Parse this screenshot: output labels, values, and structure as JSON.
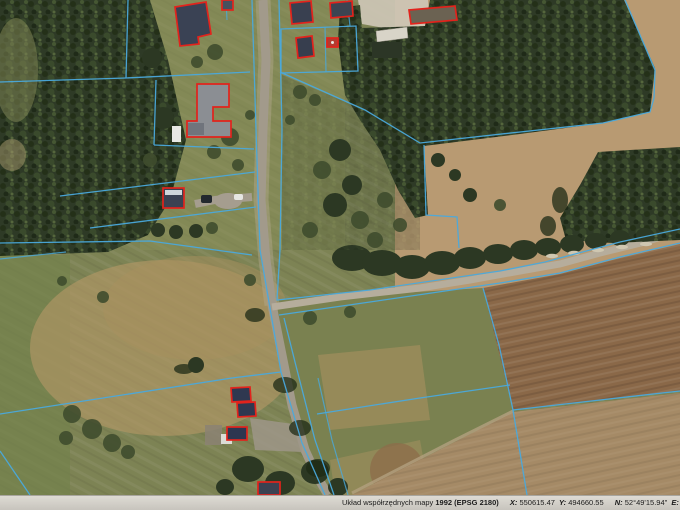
{
  "status_bar": {
    "label_crs": "Układ współrzędnych mapy",
    "crs_value": "1992 (EPSG 2180)",
    "x_label": "X:",
    "x_value": "550615.47",
    "y_label": "Y:",
    "y_value": "494660.55",
    "n_label": "N:",
    "n_value": "52°49'15.94\"",
    "e_label": "E:",
    "e_value": "18°55'14.67\"",
    "scale_label": "Aktualna Skala",
    "scale_value": "1:2000"
  },
  "colors": {
    "parcel_line": "#4aa9dc",
    "building_outline": "#e2231c",
    "grass": "#7d8354",
    "forest": "#2e3a26",
    "tan_field": "#b89a72",
    "plowed_field": "#8a6848",
    "lower_field": "#a58a66",
    "road": "#a29a8b",
    "statusbar_bg_top": "#dedbd4",
    "statusbar_bg_bottom": "#c7c4bd",
    "statusbar_text": "#1b1b1b"
  }
}
